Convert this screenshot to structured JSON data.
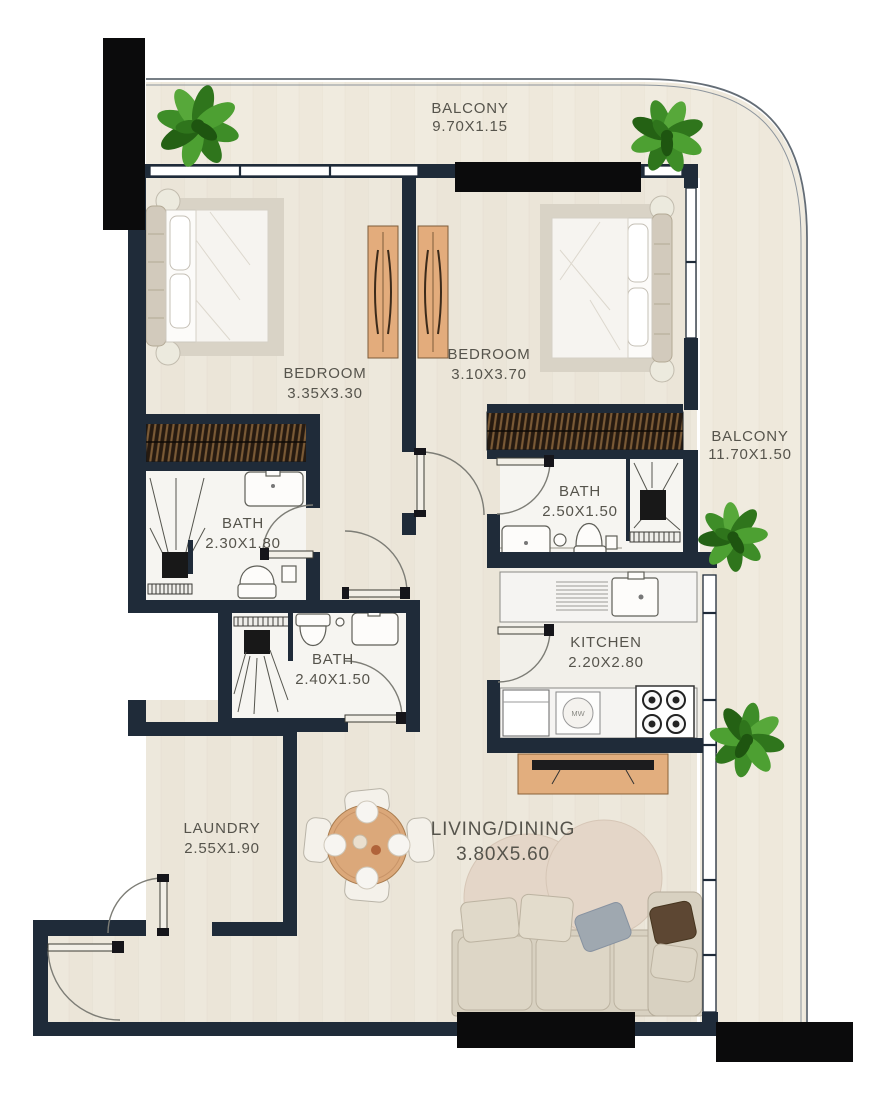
{
  "rooms": {
    "balcony_top": {
      "name": "BALCONY",
      "dims": "9.70X1.15"
    },
    "bedroom_left": {
      "name": "BEDROOM",
      "dims": "3.35X3.30"
    },
    "bedroom_right": {
      "name": "BEDROOM",
      "dims": "3.10X3.70"
    },
    "balcony_right": {
      "name": "BALCONY",
      "dims": "11.70X1.50"
    },
    "bath_left": {
      "name": "BATH",
      "dims": "2.30X1.80"
    },
    "bath_right": {
      "name": "BATH",
      "dims": "2.50X1.50"
    },
    "bath_middle": {
      "name": "BATH",
      "dims": "2.40X1.50"
    },
    "kitchen": {
      "name": "KITCHEN",
      "dims": "2.20X2.80"
    },
    "laundry": {
      "name": "LAUNDRY",
      "dims": "2.55X1.90"
    },
    "living_dining": {
      "name": "LIVING/DINING",
      "dims": "3.80X5.60"
    }
  },
  "appliances": {
    "microwave_label": "MW"
  },
  "colors": {
    "wall": "#1f2b39",
    "black_bar": "#0b0b0c",
    "floor": "#ebe5d8",
    "balcony_floor": "#eee8db",
    "bath_floor": "#f6f5f1",
    "kitchen_floor": "#f2f0ea",
    "wood": "#dfa87b",
    "wardrobe_dark": "#261a10",
    "rug": "#e4d6c8",
    "sofa": "#d8d1c1",
    "plant": "#3f8f2a",
    "label_text": "#56544c"
  }
}
